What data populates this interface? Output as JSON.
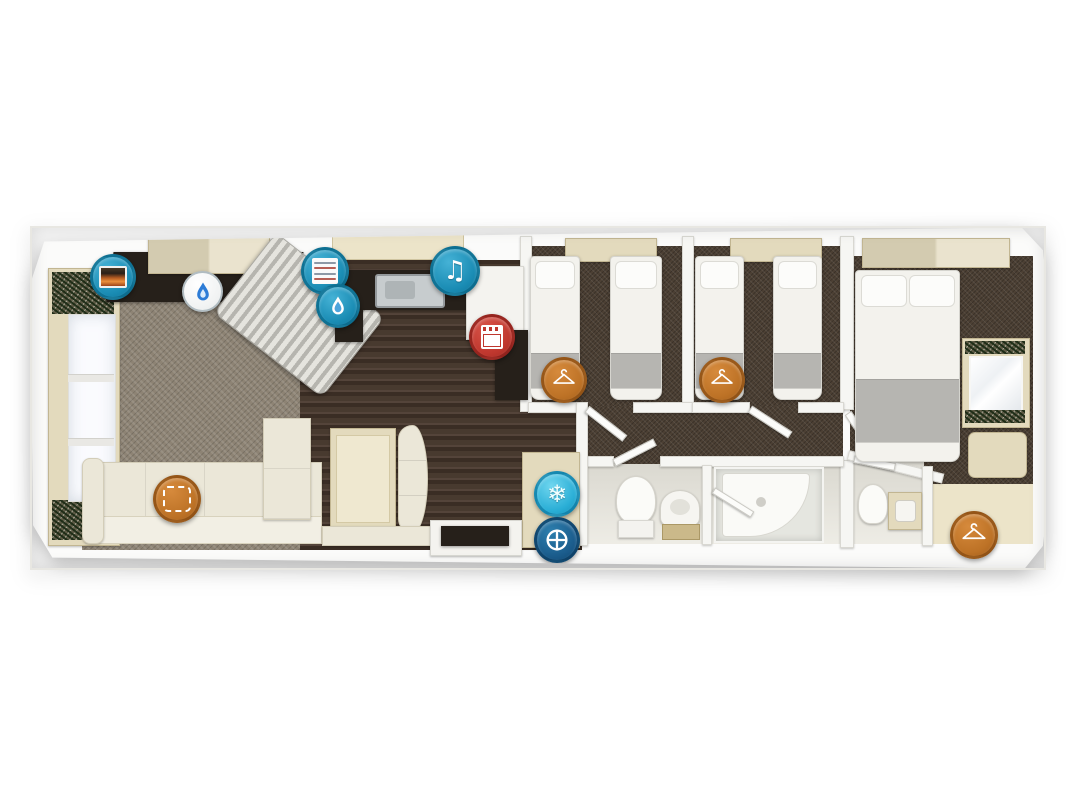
{
  "page": {
    "background_color": "#ffffff",
    "description": "Top-down 3D floor plan illustration of a static caravan holiday home, no visible text"
  },
  "plan": {
    "wall_color": "#f6f6f3",
    "rooms": [
      {
        "id": "lounge",
        "floor": "grey carpet",
        "furniture": [
          "front window wall with curtains",
          "overhead cupboard",
          "TV and fire unit",
          "striped corner armchair",
          "L-shaped cream sofa"
        ]
      },
      {
        "id": "dining-area",
        "floor": "dark wood",
        "furniture": [
          "dining table",
          "curved bench seat",
          "bottom bench"
        ]
      },
      {
        "id": "kitchen",
        "floor": "dark wood",
        "furniture": [
          "dark worktop with sink",
          "cooker unit",
          "overhead cupboard",
          "appliance tower"
        ]
      },
      {
        "id": "entrance",
        "furniture": [
          "door step unit",
          "external door"
        ]
      },
      {
        "id": "twin-bedroom-1",
        "floor": "brown carpet",
        "furniture": [
          "single bed",
          "single bed",
          "overhead shelf"
        ]
      },
      {
        "id": "twin-bedroom-2",
        "floor": "brown carpet",
        "furniture": [
          "single bed",
          "single bed",
          "overhead shelf"
        ]
      },
      {
        "id": "corridor",
        "floor": "brown carpet"
      },
      {
        "id": "bathroom",
        "floor": "light vinyl",
        "furniture": [
          "toilet",
          "wash basin",
          "shower cubicle"
        ]
      },
      {
        "id": "master-bedroom",
        "floor": "brown carpet",
        "furniture": [
          "double bed",
          "overhead cupboard",
          "dressing table with mirror",
          "stool",
          "wardrobe",
          "en-suite WC with toilet and basin"
        ]
      }
    ],
    "icons": {
      "electric_fire": {
        "name": "electric-fire-icon",
        "circle_color": "#1a8cb4"
      },
      "gas_flame": {
        "name": "gas-flame-icon",
        "circle_color": "#ffffff",
        "flame_color": "#2e7cd6"
      },
      "central_heating": {
        "name": "central-heating-icon",
        "circle_color": "#1a8cb4"
      },
      "hot_water": {
        "name": "hot-water-icon",
        "circle_color": "#1a8cb4"
      },
      "music": {
        "name": "music-icon",
        "circle_color": "#1a8cb4",
        "glyph": "♫"
      },
      "cooker": {
        "name": "cooker-icon",
        "circle_color": "#bf372e"
      },
      "fridge_freezer": {
        "name": "fridge-freezer-icon",
        "circle_color": "#2aaed6",
        "glyph": "❄"
      },
      "washing_machine": {
        "name": "washing-machine-icon",
        "circle_color": "#1b5c8c"
      },
      "wardrobe": {
        "name": "wardrobe-icon",
        "circle_color": "#bd7226",
        "count": 3
      },
      "sofa_bed": {
        "name": "sofa-bed-icon",
        "circle_color": "#bd7226"
      }
    }
  }
}
